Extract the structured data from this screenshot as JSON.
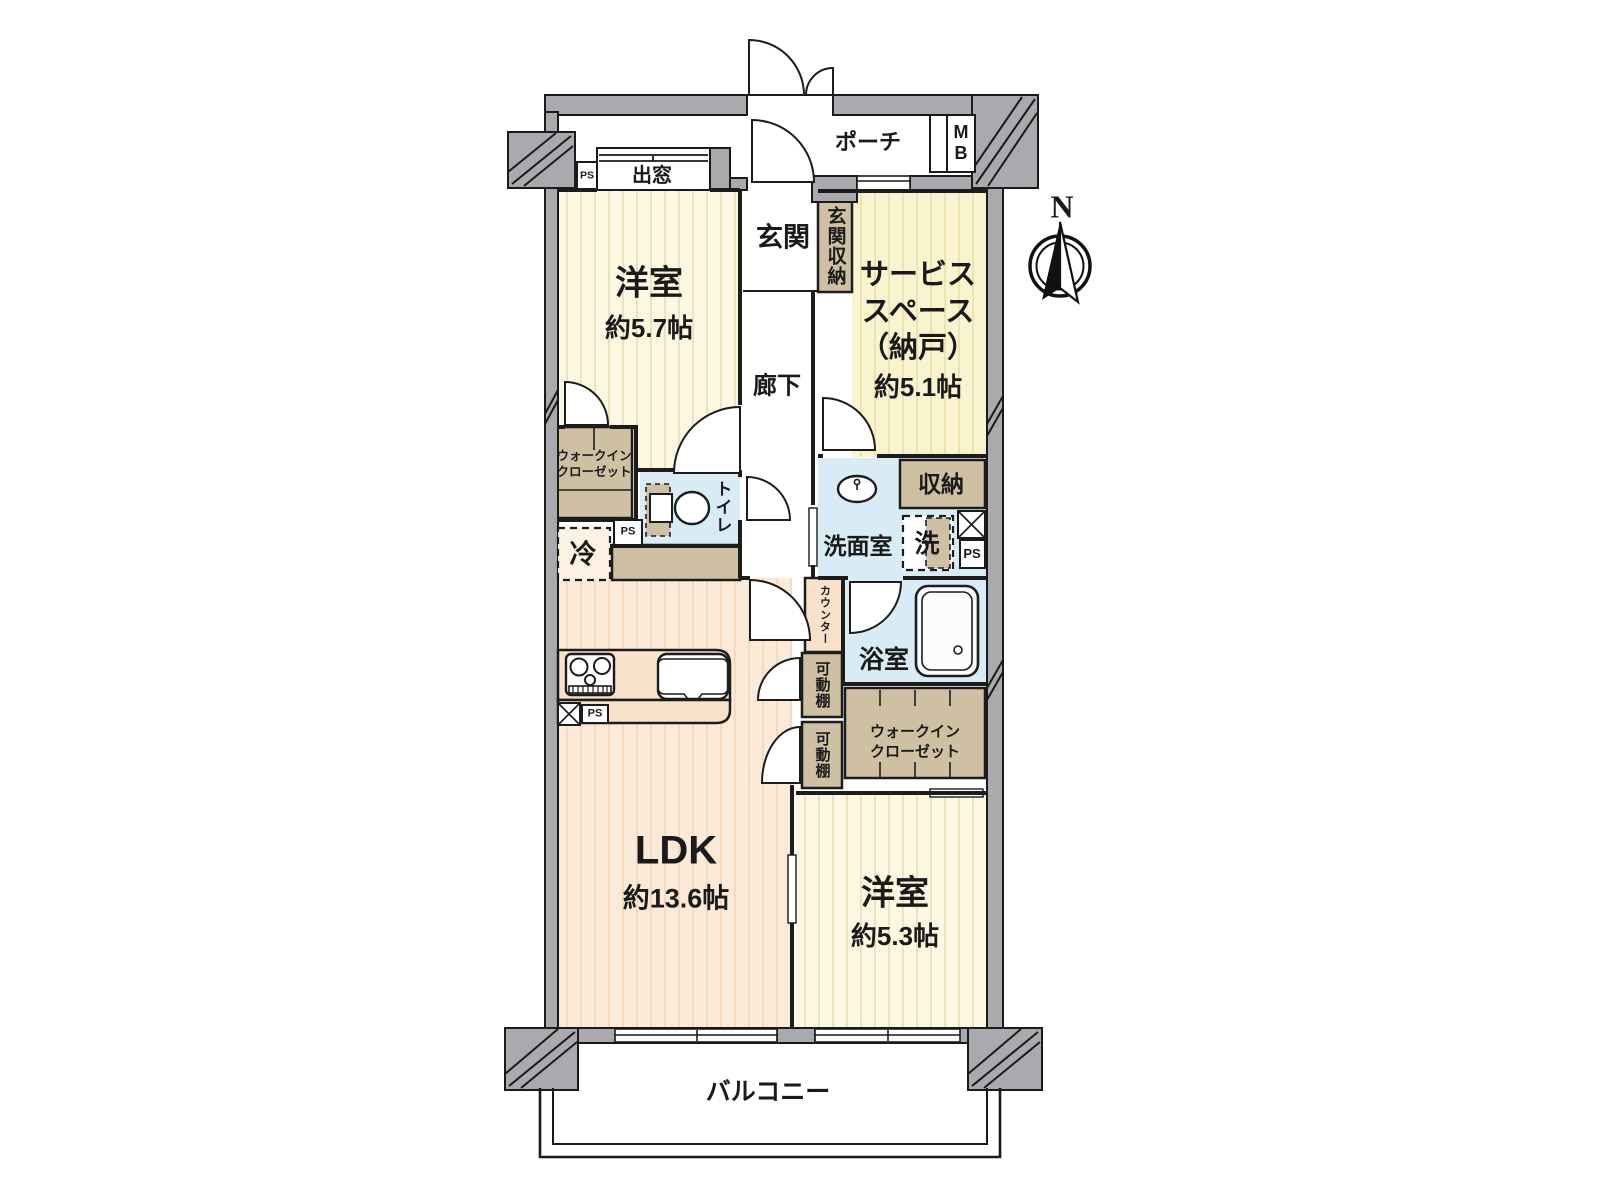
{
  "plan_type": "floor-plan",
  "rooms": {
    "western1": {
      "name": "洋室",
      "area": "約5.7帖"
    },
    "service_space": {
      "name": "サービス\nスペース\n（納戸）",
      "area": "約5.1帖"
    },
    "ldk": {
      "name": "LDK",
      "area": "約13.6帖"
    },
    "western2": {
      "name": "洋室",
      "area": "約5.3帖"
    },
    "entrance": "玄関",
    "entrance_storage": "玄関収納",
    "hallway": "廊下",
    "porch": "ポーチ",
    "balcony": "バルコニー",
    "toilet": "トイレ",
    "washroom": "洗面室",
    "bathroom": "浴室",
    "storage": "収納",
    "walk_in_closet": "ウォークイン\nクローゼット",
    "bay_window": "出窓",
    "movable_shelf": "可動棚"
  },
  "fixtures": {
    "refrigerator": "冷",
    "washer": "洗",
    "counter": "カウンター"
  },
  "utility": {
    "meter_box": "MB",
    "pipe_space": "PS"
  },
  "compass": {
    "north": "N"
  },
  "colors": {
    "wall_gray": "#a9aaad",
    "outline_black": "#1a1a1a",
    "room_cream": "#fbf7e1",
    "room_yellow": "#faf3d0",
    "room_peach": "#fcead8",
    "wet_area_blue": "#d9ecf6",
    "closet_tan": "#cfc0a4",
    "counter_peach": "#f9e2c9"
  }
}
